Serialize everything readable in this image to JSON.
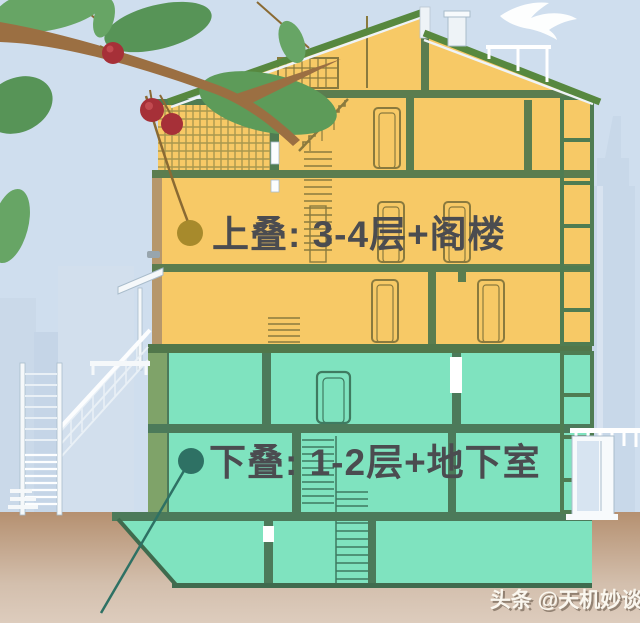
{
  "labels": {
    "upper": {
      "text": "上叠: 3-4层+阁楼",
      "marker_color": "#a78a2c"
    },
    "lower": {
      "text": "下叠: 1-2层+地下室",
      "marker_color": "#2e7164"
    }
  },
  "watermark": {
    "text": "头条 @天机妙谈"
  },
  "palette": {
    "sky": "#cfdeee",
    "skyline": "#c8d8e9",
    "ground_top": "#b59070",
    "ground_bottom": "#ddccbd",
    "upper_fill": "#f7c966",
    "lower_fill": "#7fe3bf",
    "roof": "#57883f",
    "slab_upper": "#5b7d4f",
    "slab_lower": "#4c7a5a",
    "label_text": "#4b4c50",
    "leaf": "#67a565",
    "branch": "#9b6f42",
    "berry": "#a63038"
  }
}
